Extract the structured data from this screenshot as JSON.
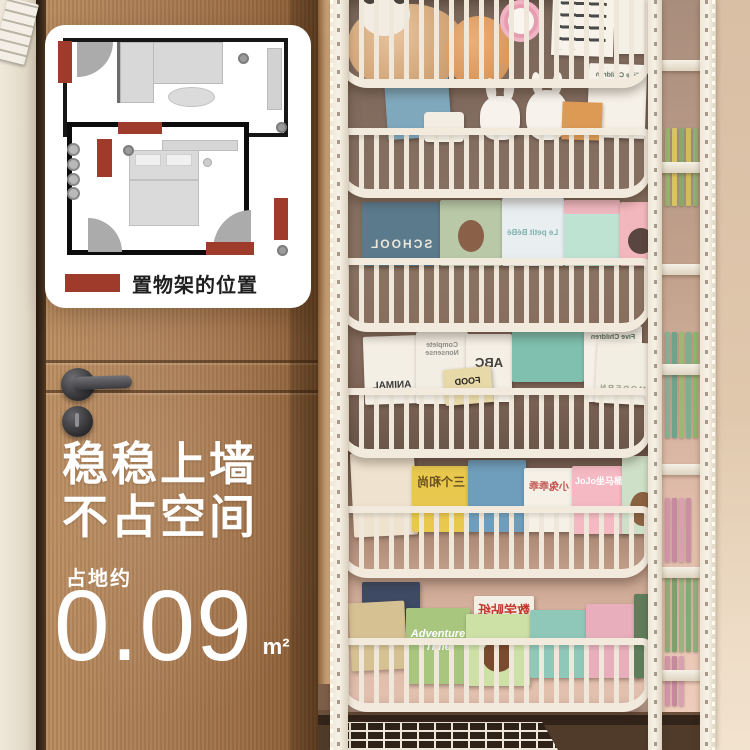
{
  "plan_card": {
    "legend_label": "置物架的位置",
    "marker_color": "#9e3b2b"
  },
  "overlay": {
    "headline_line1": "稳稳上墙",
    "headline_line2": "不占空间",
    "area_label": "占地约",
    "area_value": "0.09",
    "area_unit": "m²",
    "text_color": "#ffffff"
  },
  "shelf": {
    "frame_color": "#f1eadd",
    "back_panel_color": "#8b7363",
    "tiers": [
      {
        "name": "tier-1",
        "items": [
          "plush-panda",
          "plush-toy",
          "pink-clock",
          "calendar-board",
          "white-box"
        ],
        "books": []
      },
      {
        "name": "tier-2",
        "items": [
          "bunny-ornament",
          "bunny-ornament",
          "orange-booklet",
          "white-mug"
        ],
        "books": [
          {
            "label": "",
            "color": "#7fa8bd"
          },
          {
            "label": "Five Children and It",
            "color": "#f6f1e8",
            "label_color": "#5a6e5a",
            "mirrored": true
          }
        ]
      },
      {
        "name": "tier-3",
        "books": [
          {
            "label": "SCHOOL",
            "color": "#5b7a8c",
            "label_color": "#ece7db",
            "mirrored": true
          },
          {
            "label": "",
            "color": "#b9c9a8"
          },
          {
            "label": "Le petit BéBé",
            "color": "#e9eef0",
            "label_color": "#7fb3b0",
            "mirrored": true
          },
          {
            "label": "",
            "color": "#bfe3d2"
          },
          {
            "label": "",
            "color": "#f2b7bd"
          }
        ]
      },
      {
        "name": "tier-4",
        "books": [
          {
            "label": "ANIMAL",
            "color": "#f4efe5",
            "label_color": "#3a3a3a",
            "mirrored": true
          },
          {
            "label": "Complete Nonsense",
            "color": "#f3eee4",
            "label_color": "#8d8d86",
            "mirrored": true
          },
          {
            "label": "ABC",
            "color": "#f5f0e6",
            "label_color": "#44423c",
            "mirrored": true
          },
          {
            "label": "",
            "color": "#7fc0ae"
          },
          {
            "label": "FOOD",
            "color": "#e8d9a8",
            "label_color": "#26231f",
            "mirrored": true
          },
          {
            "label": "Five Children and It",
            "color": "#f6f1e8",
            "label_color": "#5a6e5a",
            "mirrored": true
          },
          {
            "label": "MODERN",
            "color": "#f3eee2",
            "label_color": "#9aa08a",
            "mirrored": true
          }
        ]
      },
      {
        "name": "tier-5",
        "books": [
          {
            "label": "",
            "color": "#efe3cf"
          },
          {
            "label": "三个和尚",
            "color": "#e9c84e",
            "label_color": "#684f22",
            "mirrored": true
          },
          {
            "label": "",
            "color": "#6f9ebc"
          },
          {
            "label": "小兔乖乖",
            "color": "#f6f1e7",
            "label_color": "#c0504d",
            "mirrored": true
          },
          {
            "label": "JoJo坐马桶",
            "color": "#f4b9c3",
            "label_color": "#ffffff",
            "mirrored": false
          },
          {
            "label": "",
            "color": "#cfe0c8"
          }
        ]
      },
      {
        "name": "tier-6",
        "books": [
          {
            "label": "",
            "color": "#3e4a63"
          },
          {
            "label": "",
            "color": "#d6c193"
          },
          {
            "label": "Adventure Time",
            "color": "#a8c67e",
            "label_color": "#ffffff",
            "mirrored": false
          },
          {
            "label": "数学贴纸",
            "color": "#f3efe5",
            "label_color": "#c0392b",
            "mirrored": true
          },
          {
            "label": "",
            "color": "#cde0a6"
          },
          {
            "label": "",
            "color": "#8fc7b9"
          },
          {
            "label": "",
            "color": "#e8aebc"
          },
          {
            "label": "",
            "color": "#5f7d5a"
          }
        ]
      }
    ],
    "side_column": {
      "spine_groups": [
        {
          "colors": [
            "#9ab06e",
            "#d9c465",
            "#8aa86a",
            "#cdbd5e",
            "#93ad72"
          ]
        },
        {
          "colors": [
            "#86b193",
            "#6fa38a",
            "#9cb974",
            "#7fae8e",
            "#8fb56f"
          ]
        },
        {
          "colors": [
            "#d495a8",
            "#c7899d",
            "#d8a0b1",
            "#cb8fa2"
          ]
        },
        {
          "colors": [
            "#8fae77",
            "#7da06c",
            "#98b581",
            "#86a873",
            "#90b07c"
          ]
        },
        {
          "colors": [
            "#d495a8",
            "#c7899d",
            "#d8a0b1"
          ]
        }
      ]
    }
  }
}
